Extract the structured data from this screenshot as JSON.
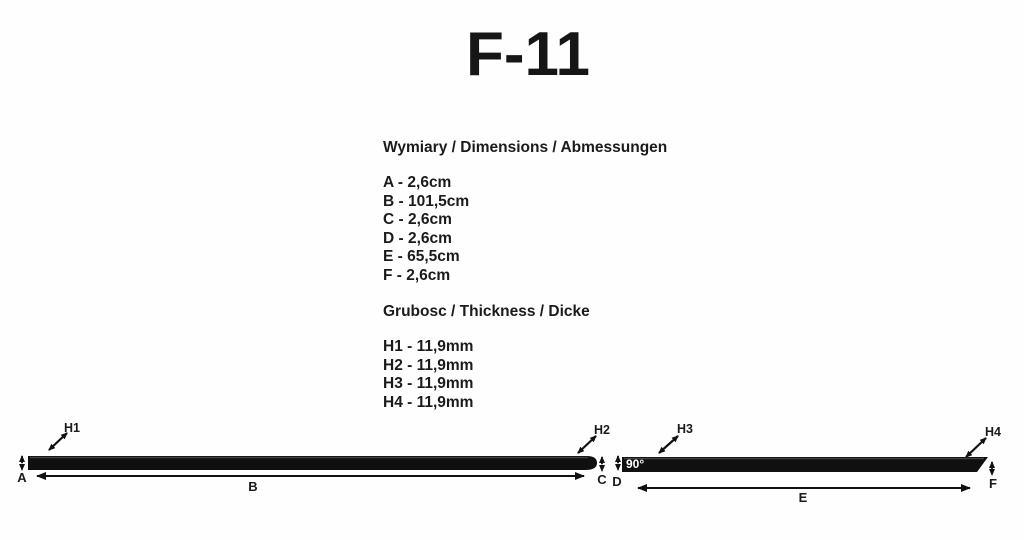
{
  "title": "F-11",
  "dimensions_section": {
    "heading": "Wymiary / Dimensions / Abmessungen",
    "items": [
      "A - 2,6cm",
      "B - 101,5cm",
      "C - 2,6cm",
      "D - 2,6cm",
      "E - 65,5cm",
      "F - 2,6cm"
    ]
  },
  "thickness_section": {
    "heading": "Grubosc / Thickness / Dicke",
    "items": [
      "H1 - 11,9mm",
      "H2 - 11,9mm",
      "H3 - 11,9mm",
      "H4 - 11,9mm"
    ]
  },
  "diagram": {
    "angle_label": "90°",
    "labels": {
      "a": "A",
      "b": "B",
      "c": "C",
      "d": "D",
      "e": "E",
      "f": "F",
      "h1": "H1",
      "h2": "H2",
      "h3": "H3",
      "h4": "H4"
    }
  },
  "colors": {
    "background": "#fefefe",
    "text": "#1b1b1b",
    "strip": "#101010",
    "angle_text": "#ffffff"
  }
}
